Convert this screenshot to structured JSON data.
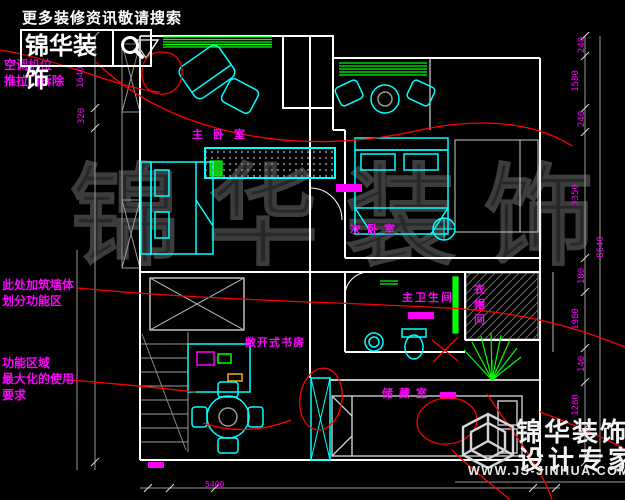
{
  "header": {
    "tagline": "更多装修资讯敬请搜索",
    "logo_text": "锦华装饰"
  },
  "annotations": {
    "ac_line1": "空调机位",
    "ac_line2": "推拉门拆除",
    "wall_line1": "此处加筑墙体",
    "wall_line2": "划分功能区",
    "func_line1": "功能区域",
    "func_line2": "最大化的使用",
    "func_line3": "要求"
  },
  "rooms": {
    "master_bedroom": "主卧室",
    "second_bedroom": "次卧室",
    "master_bath": "主卫生间",
    "cloakroom": "衣帽间",
    "open_study": "敞开式书房",
    "storage": "储藏室"
  },
  "dimensions": {
    "left": [
      "1640",
      "320"
    ],
    "right": [
      "240",
      "1580",
      "240",
      "3350",
      "180",
      "1980",
      "140",
      "1280"
    ],
    "right_total": "8640",
    "bottom": "5400"
  },
  "watermark": {
    "giant": "锦华装饰",
    "brand1": "锦华装饰",
    "brand2": "设计专家",
    "site": "WWW.JS-JINHUA.COM"
  },
  "colors": {
    "wall": "#ffffff",
    "furniture": "#00ffff",
    "window": "#00ff00",
    "annotation": "#ff00ff",
    "revision": "#ff0000",
    "background": "#000000"
  }
}
